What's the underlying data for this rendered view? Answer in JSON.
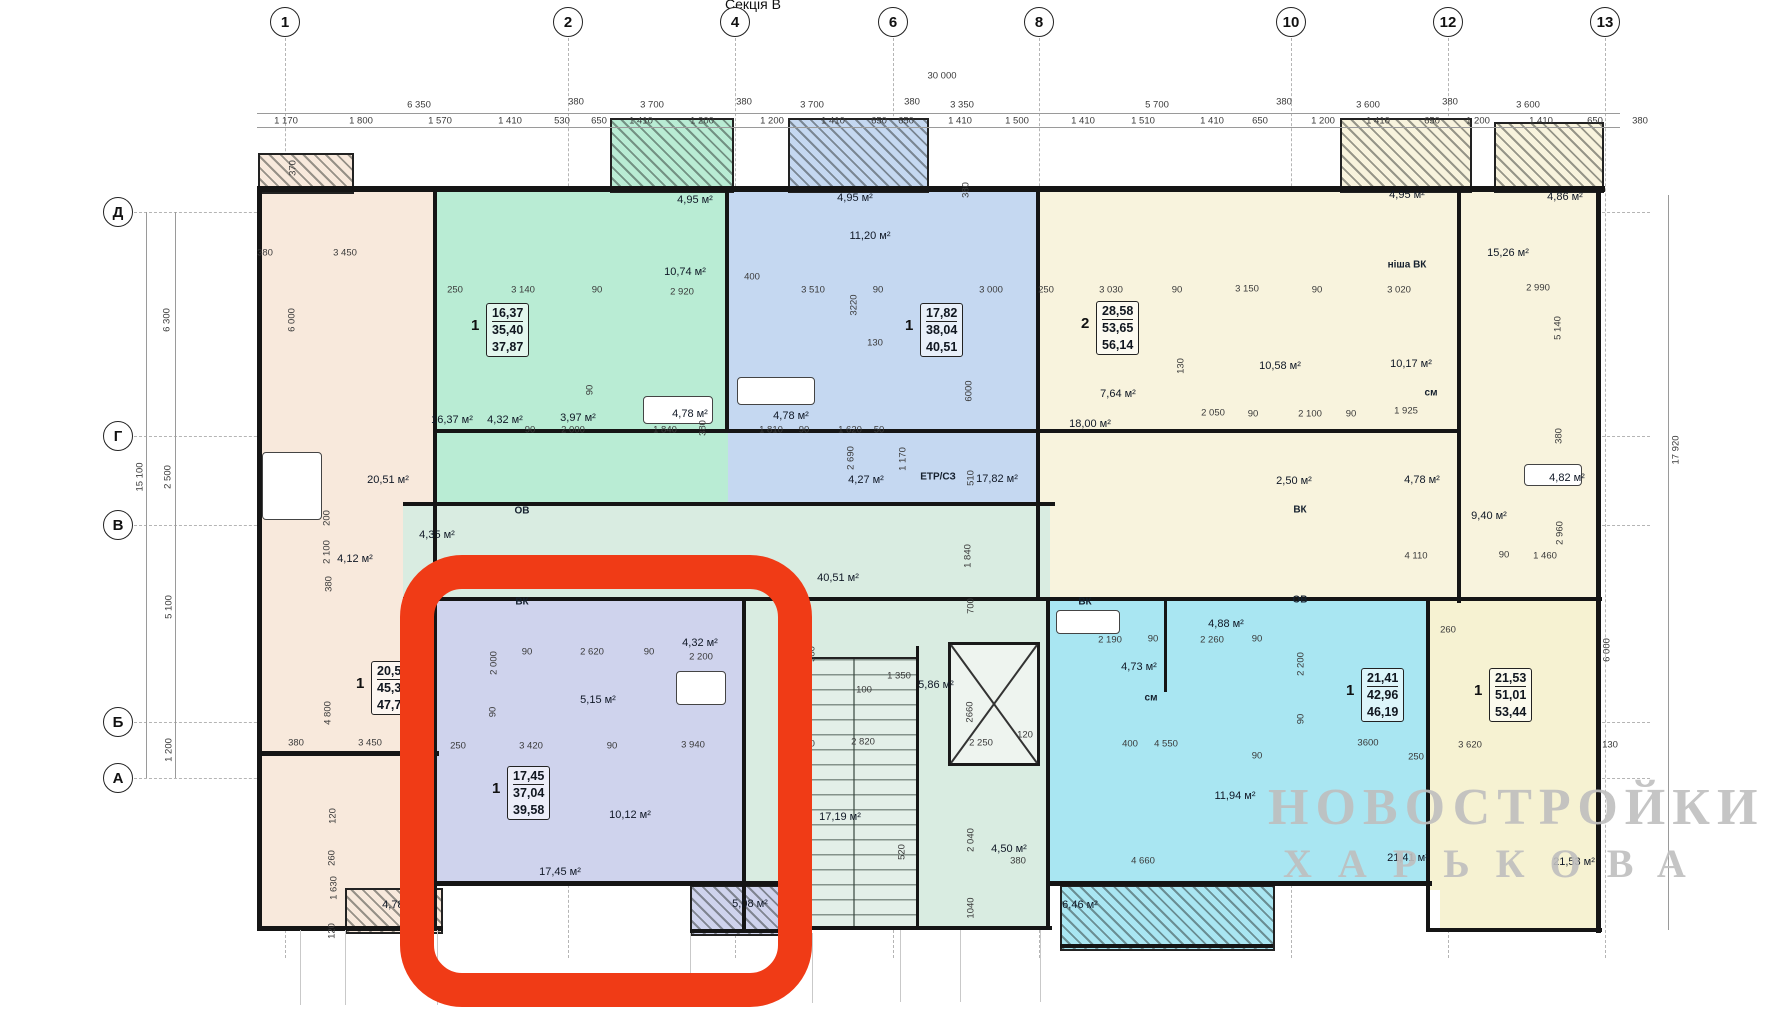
{
  "title": "Секція В",
  "watermark": {
    "l1": "НОВОСТРОЙКИ",
    "l2": "ХАРЬКОВА"
  },
  "colors": {
    "accent_red": "#f03b16",
    "peach": "#f8e9dc",
    "green": "#b9ecd4",
    "blue": "#c5d8f1",
    "cream": "#f8f3dd",
    "corridor": "#d9ece1",
    "lavender": "#cfd3ed",
    "cyan": "#a9e6f2",
    "yellow": "#f6f2d2",
    "watermark_gray": "#bfbfbf"
  },
  "axis": {
    "columns": [
      {
        "n": "1",
        "x": 285
      },
      {
        "n": "2",
        "x": 568
      },
      {
        "n": "4",
        "x": 735
      },
      {
        "n": "6",
        "x": 893
      },
      {
        "n": "8",
        "x": 1039
      },
      {
        "n": "10",
        "x": 1291
      },
      {
        "n": "12",
        "x": 1448
      },
      {
        "n": "13",
        "x": 1605
      }
    ],
    "rows": [
      {
        "n": "Д",
        "y": 212
      },
      {
        "n": "Г",
        "y": 436
      },
      {
        "n": "В",
        "y": 525
      },
      {
        "n": "Б",
        "y": 722
      },
      {
        "n": "А",
        "y": 778
      }
    ],
    "total_width": "30 000",
    "total_height": "15 100",
    "right_height": "17 920"
  },
  "dims_top_main": [
    {
      "t": "6 350",
      "x": 419
    },
    {
      "t": "3 700",
      "x": 652
    },
    {
      "t": "3 700",
      "x": 812
    },
    {
      "t": "3 350",
      "x": 962
    },
    {
      "t": "5 700",
      "x": 1157
    },
    {
      "t": "3 600",
      "x": 1368
    },
    {
      "t": "3 600",
      "x": 1528
    }
  ],
  "dims_top_detail": [
    {
      "t": "1 170",
      "x": 286
    },
    {
      "t": "1 800",
      "x": 361
    },
    {
      "t": "1 570",
      "x": 440
    },
    {
      "t": "1 410",
      "x": 510
    },
    {
      "t": "530",
      "x": 562
    },
    {
      "t": "650",
      "x": 599
    },
    {
      "t": "1 410",
      "x": 641
    },
    {
      "t": "1 200",
      "x": 702
    },
    {
      "t": "1 200",
      "x": 772
    },
    {
      "t": "1 410",
      "x": 833
    },
    {
      "t": "650",
      "x": 879
    },
    {
      "t": "650",
      "x": 906
    },
    {
      "t": "1 410",
      "x": 960
    },
    {
      "t": "1 500",
      "x": 1017
    },
    {
      "t": "1 410",
      "x": 1083
    },
    {
      "t": "1 510",
      "x": 1143
    },
    {
      "t": "1 410",
      "x": 1212
    },
    {
      "t": "650",
      "x": 1260
    },
    {
      "t": "1 200",
      "x": 1323
    },
    {
      "t": "1 410",
      "x": 1378
    },
    {
      "t": "650",
      "x": 1432
    },
    {
      "t": "1 200",
      "x": 1478
    },
    {
      "t": "1 410",
      "x": 1541
    },
    {
      "t": "650",
      "x": 1595
    },
    {
      "t": "380",
      "x": 1640
    }
  ],
  "dims_top_380": [
    576,
    744,
    912,
    1284,
    1450
  ],
  "dims_side": [
    {
      "t": "15 100",
      "x": 140,
      "y": 477
    },
    {
      "t": "6 300",
      "x": 167,
      "y": 320
    },
    {
      "t": "2 500",
      "x": 168,
      "y": 477
    },
    {
      "t": "5 100",
      "x": 169,
      "y": 607
    },
    {
      "t": "1 200",
      "x": 169,
      "y": 750
    },
    {
      "t": "370",
      "x": 293,
      "y": 168
    },
    {
      "t": "17 920",
      "x": 1676,
      "y": 450
    }
  ],
  "labels": [
    [
      "4,95 м²",
      695,
      200,
      0,
      1
    ],
    [
      "4,95 м²",
      855,
      198,
      0,
      1
    ],
    [
      "4,95 м²",
      1407,
      195,
      0,
      1
    ],
    [
      "4,86 м²",
      1565,
      197,
      0,
      1
    ],
    [
      "10,74 м²",
      685,
      272,
      0,
      1
    ],
    [
      "250",
      455,
      290,
      0,
      0
    ],
    [
      "3 140",
      523,
      290,
      0,
      0
    ],
    [
      "90",
      597,
      290,
      0,
      0
    ],
    [
      "2 920",
      682,
      292,
      0,
      0
    ],
    [
      "90",
      590,
      390,
      1,
      0
    ],
    [
      "90",
      530,
      430,
      0,
      0
    ],
    [
      "2 000",
      573,
      430,
      0,
      0
    ],
    [
      "1 840",
      665,
      430,
      0,
      0
    ],
    [
      "380",
      703,
      428,
      1,
      0
    ],
    [
      "16,37 м²",
      452,
      420,
      0,
      1
    ],
    [
      "4,32 м²",
      505,
      420,
      0,
      1
    ],
    [
      "3,97 м²",
      578,
      418,
      0,
      1
    ],
    [
      "4,78 м²",
      690,
      414,
      0,
      1
    ],
    [
      "11,20 м²",
      870,
      236,
      0,
      1
    ],
    [
      "400",
      752,
      277,
      0,
      0
    ],
    [
      "3 510",
      813,
      290,
      0,
      0
    ],
    [
      "3220",
      854,
      305,
      1,
      0
    ],
    [
      "90",
      878,
      290,
      0,
      0
    ],
    [
      "3 000",
      991,
      290,
      0,
      0
    ],
    [
      "380",
      966,
      190,
      1,
      0
    ],
    [
      "130",
      875,
      343,
      0,
      0
    ],
    [
      "6000",
      969,
      391,
      1,
      0
    ],
    [
      "4,78 м²",
      791,
      416,
      0,
      1
    ],
    [
      "1 810",
      771,
      430,
      0,
      0
    ],
    [
      "90",
      804,
      430,
      0,
      0
    ],
    [
      "1 620",
      850,
      430,
      0,
      0
    ],
    [
      "50",
      879,
      430,
      0,
      0
    ],
    [
      "2 690",
      851,
      458,
      1,
      0
    ],
    [
      "1 170",
      903,
      459,
      1,
      0
    ],
    [
      "510",
      971,
      478,
      1,
      0
    ],
    [
      "4,27 м²",
      866,
      480,
      0,
      1
    ],
    [
      "ЕТР/СЗ",
      938,
      477,
      0,
      2
    ],
    [
      "17,82 м²",
      997,
      479,
      0,
      1
    ],
    [
      "250",
      1046,
      290,
      0,
      0
    ],
    [
      "3 030",
      1111,
      290,
      0,
      0
    ],
    [
      "90",
      1177,
      290,
      0,
      0
    ],
    [
      "3 150",
      1247,
      289,
      0,
      0
    ],
    [
      "90",
      1317,
      290,
      0,
      0
    ],
    [
      "3 020",
      1399,
      290,
      0,
      0
    ],
    [
      "18,00 м²",
      1090,
      424,
      0,
      1
    ],
    [
      "7,64 м²",
      1118,
      394,
      0,
      1
    ],
    [
      "10,58 м²",
      1280,
      366,
      0,
      1
    ],
    [
      "10,17 м²",
      1411,
      364,
      0,
      1
    ],
    [
      "130",
      1181,
      366,
      1,
      0
    ],
    [
      "2 050",
      1213,
      413,
      0,
      0
    ],
    [
      "90",
      1253,
      414,
      0,
      0
    ],
    [
      "2 100",
      1310,
      414,
      0,
      0
    ],
    [
      "90",
      1351,
      414,
      0,
      0
    ],
    [
      "1 925",
      1406,
      411,
      0,
      0
    ],
    [
      "см",
      1431,
      393,
      0,
      2
    ],
    [
      "ніша ВК",
      1407,
      265,
      0,
      2
    ],
    [
      "15,26 м²",
      1508,
      253,
      0,
      1
    ],
    [
      "2 990",
      1538,
      288,
      0,
      0
    ],
    [
      "5 140",
      1558,
      328,
      1,
      0
    ],
    [
      "380",
      1559,
      436,
      1,
      0
    ],
    [
      "2,50 м²",
      1294,
      481,
      0,
      1
    ],
    [
      "4,78 м²",
      1422,
      480,
      0,
      1
    ],
    [
      "4,82 м²",
      1567,
      478,
      0,
      1
    ],
    [
      "9,40 м²",
      1489,
      516,
      0,
      1
    ],
    [
      "4 110",
      1416,
      556,
      0,
      0
    ],
    [
      "90",
      1504,
      555,
      0,
      0
    ],
    [
      "1 460",
      1545,
      556,
      0,
      0
    ],
    [
      "2 960",
      1560,
      533,
      1,
      0
    ],
    [
      "ВК",
      1300,
      510,
      0,
      2
    ],
    [
      "ОВ",
      1300,
      600,
      0,
      2
    ],
    [
      "380",
      265,
      253,
      0,
      0
    ],
    [
      "3 450",
      345,
      253,
      0,
      0
    ],
    [
      "6 000",
      292,
      320,
      1,
      0
    ],
    [
      "20,51 м²",
      388,
      480,
      0,
      1
    ],
    [
      "4,35 м²",
      437,
      535,
      0,
      1
    ],
    [
      "4,12 м²",
      355,
      559,
      0,
      1
    ],
    [
      "2 100",
      327,
      552,
      1,
      0
    ],
    [
      "200",
      327,
      518,
      1,
      0
    ],
    [
      "380",
      329,
      584,
      1,
      0
    ],
    [
      "4 800",
      328,
      713,
      1,
      0
    ],
    [
      "380",
      296,
      743,
      0,
      0
    ],
    [
      "3 450",
      370,
      743,
      0,
      0
    ],
    [
      "120",
      333,
      816,
      1,
      0
    ],
    [
      "260",
      332,
      858,
      1,
      0
    ],
    [
      "1 630",
      334,
      888,
      1,
      0
    ],
    [
      "120",
      332,
      931,
      1,
      0
    ],
    [
      "4,78 м²",
      400,
      905,
      0,
      1
    ],
    [
      "ОВ",
      522,
      511,
      0,
      2
    ],
    [
      "ВК",
      522,
      602,
      0,
      2
    ],
    [
      "40,51 м²",
      838,
      578,
      0,
      1
    ],
    [
      "1 840",
      968,
      556,
      1,
      0
    ],
    [
      "700",
      971,
      606,
      1,
      0
    ],
    [
      "ВК",
      1085,
      602,
      0,
      2
    ],
    [
      "380",
      812,
      654,
      1,
      0
    ],
    [
      "100",
      864,
      690,
      0,
      0
    ],
    [
      "1 350",
      899,
      676,
      0,
      0
    ],
    [
      "2 820",
      863,
      742,
      0,
      0
    ],
    [
      "380",
      807,
      744,
      0,
      0
    ],
    [
      "2 250",
      981,
      743,
      0,
      0
    ],
    [
      "120",
      1025,
      735,
      0,
      0
    ],
    [
      "5,86 м²",
      936,
      685,
      0,
      1
    ],
    [
      "2660",
      970,
      712,
      1,
      0
    ],
    [
      "520",
      902,
      852,
      1,
      0
    ],
    [
      "17,19 м²",
      840,
      817,
      0,
      1
    ],
    [
      "2 040",
      971,
      840,
      1,
      0
    ],
    [
      "1040",
      971,
      908,
      1,
      0
    ],
    [
      "4,50 м²",
      1009,
      849,
      0,
      1
    ],
    [
      "380",
      1018,
      861,
      0,
      0
    ],
    [
      "2 000",
      494,
      663,
      1,
      0
    ],
    [
      "90",
      527,
      652,
      0,
      0
    ],
    [
      "2 620",
      592,
      652,
      0,
      0
    ],
    [
      "90",
      649,
      652,
      0,
      0
    ],
    [
      "4,32 м²",
      700,
      643,
      0,
      1
    ],
    [
      "2 200",
      701,
      657,
      0,
      0
    ],
    [
      "5,15 м²",
      598,
      700,
      0,
      1
    ],
    [
      "90",
      493,
      712,
      1,
      0
    ],
    [
      "250",
      458,
      746,
      0,
      0
    ],
    [
      "3 420",
      531,
      746,
      0,
      0
    ],
    [
      "90",
      612,
      746,
      0,
      0
    ],
    [
      "3 940",
      693,
      745,
      0,
      0
    ],
    [
      "10,12 м²",
      630,
      815,
      0,
      1
    ],
    [
      "17,45 м²",
      560,
      872,
      0,
      1
    ],
    [
      "5,08 м²",
      750,
      904,
      0,
      1
    ],
    [
      "2 190",
      1110,
      640,
      0,
      0
    ],
    [
      "90",
      1153,
      639,
      0,
      0
    ],
    [
      "2 260",
      1212,
      640,
      0,
      0
    ],
    [
      "90",
      1257,
      639,
      0,
      0
    ],
    [
      "4,88 м²",
      1226,
      624,
      0,
      1
    ],
    [
      "4,73 м²",
      1139,
      667,
      0,
      1
    ],
    [
      "см",
      1151,
      698,
      0,
      2
    ],
    [
      "2 200",
      1301,
      664,
      1,
      0
    ],
    [
      "90",
      1301,
      719,
      1,
      0
    ],
    [
      "4 550",
      1166,
      744,
      0,
      0
    ],
    [
      "90",
      1257,
      756,
      0,
      0
    ],
    [
      "3600",
      1368,
      743,
      0,
      0
    ],
    [
      "250",
      1416,
      757,
      0,
      0
    ],
    [
      "400",
      1130,
      744,
      0,
      0
    ],
    [
      "11,94 м²",
      1235,
      796,
      0,
      1
    ],
    [
      "4 660",
      1143,
      861,
      0,
      0
    ],
    [
      "21,41 м²",
      1408,
      858,
      0,
      1
    ],
    [
      "6,46 м²",
      1080,
      905,
      0,
      1
    ],
    [
      "260",
      1448,
      630,
      0,
      0
    ],
    [
      "3 620",
      1470,
      745,
      0,
      0
    ],
    [
      "130",
      1610,
      745,
      0,
      0
    ],
    [
      "21,53 м²",
      1574,
      862,
      0,
      1
    ],
    [
      "6 000",
      1607,
      650,
      1,
      0
    ]
  ],
  "apartment_boxes": [
    {
      "p": "1",
      "v": [
        "16,37",
        "35,40",
        "37,87"
      ],
      "x": 486,
      "y": 303
    },
    {
      "p": "1",
      "v": [
        "17,82",
        "38,04",
        "40,51"
      ],
      "x": 920,
      "y": 303
    },
    {
      "p": "2",
      "v": [
        "28,58",
        "53,65",
        "56,14"
      ],
      "x": 1096,
      "y": 301
    },
    {
      "p": "1",
      "v": [
        "20,5",
        "45,3",
        "47,7"
      ],
      "x": 371,
      "y": 661
    },
    {
      "p": "1",
      "v": [
        "17,45",
        "37,04",
        "39,58"
      ],
      "x": 507,
      "y": 766
    },
    {
      "p": "1",
      "v": [
        "21,41",
        "42,96",
        "46,19"
      ],
      "x": 1361,
      "y": 668
    },
    {
      "p": "1",
      "v": [
        "21,53",
        "51,01",
        "53,44"
      ],
      "x": 1489,
      "y": 668
    }
  ],
  "rooms": [
    [
      "peach",
      257,
      190,
      180,
      740
    ],
    [
      "green",
      437,
      190,
      291,
      315
    ],
    [
      "blue",
      728,
      190,
      312,
      315
    ],
    [
      "cream",
      1040,
      190,
      420,
      315
    ],
    [
      "cream",
      1460,
      190,
      140,
      412
    ],
    [
      "cream",
      1040,
      505,
      420,
      95
    ],
    [
      "corr",
      403,
      505,
      647,
      95
    ],
    [
      "corr",
      745,
      600,
      305,
      330
    ],
    [
      "lav",
      437,
      600,
      308,
      285
    ],
    [
      "cyan",
      1050,
      600,
      380,
      285
    ],
    [
      "yellow",
      1430,
      600,
      170,
      290
    ],
    [
      "yellow",
      1440,
      885,
      160,
      47
    ]
  ],
  "balconies": [
    [
      258,
      153,
      92,
      37,
      "peach"
    ],
    [
      610,
      118,
      120,
      71,
      "green"
    ],
    [
      788,
      118,
      137,
      71,
      "blue"
    ],
    [
      1340,
      118,
      128,
      71,
      "cream"
    ],
    [
      1494,
      122,
      106,
      67,
      "cream"
    ],
    [
      690,
      885,
      106,
      47,
      "lav"
    ],
    [
      1060,
      885,
      211,
      62,
      "cyan"
    ],
    [
      345,
      888,
      94,
      42,
      "peach"
    ]
  ],
  "walls_h": [
    [
      257,
      186,
      1348,
      6
    ],
    [
      437,
      429,
      1023,
      4
    ],
    [
      403,
      502,
      652,
      4
    ],
    [
      403,
      597,
      1199,
      4
    ],
    [
      257,
      751,
      182,
      5
    ],
    [
      257,
      926,
      186,
      5
    ],
    [
      437,
      881,
      362,
      5
    ],
    [
      690,
      929,
      112,
      4
    ],
    [
      1050,
      881,
      382,
      5
    ],
    [
      1060,
      944,
      213,
      4
    ],
    [
      1430,
      928,
      172,
      4
    ],
    [
      800,
      926,
      252,
      4
    ]
  ],
  "walls_v": [
    [
      257,
      186,
      5,
      745
    ],
    [
      433,
      186,
      4,
      745
    ],
    [
      725,
      186,
      4,
      247
    ],
    [
      1036,
      186,
      4,
      415
    ],
    [
      1457,
      186,
      4,
      417
    ],
    [
      1596,
      186,
      5,
      747
    ],
    [
      742,
      600,
      4,
      332
    ],
    [
      916,
      646,
      3,
      284
    ],
    [
      1046,
      600,
      4,
      330
    ],
    [
      1426,
      600,
      4,
      332
    ],
    [
      1164,
      600,
      3,
      92
    ]
  ],
  "fixtures": [
    [
      643,
      396,
      68,
      26
    ],
    [
      737,
      377,
      76,
      26
    ],
    [
      676,
      671,
      48,
      32
    ],
    [
      1056,
      610,
      62,
      22
    ],
    [
      1524,
      464,
      56,
      20
    ],
    [
      262,
      452,
      58,
      66
    ]
  ],
  "stairs": {
    "x": 787,
    "y": 657,
    "w": 128,
    "h": 268
  },
  "elevator": {
    "x": 948,
    "y": 642,
    "w": 86,
    "h": 118
  },
  "red_box": {
    "x": 400,
    "y": 555,
    "w": 412,
    "h": 452
  },
  "ext_lines": [
    [
      300,
      930,
      75
    ],
    [
      345,
      930,
      75
    ],
    [
      437,
      930,
      75
    ],
    [
      690,
      933,
      70
    ],
    [
      812,
      933,
      70
    ],
    [
      900,
      930,
      72
    ],
    [
      960,
      930,
      72
    ],
    [
      1040,
      930,
      72
    ]
  ]
}
